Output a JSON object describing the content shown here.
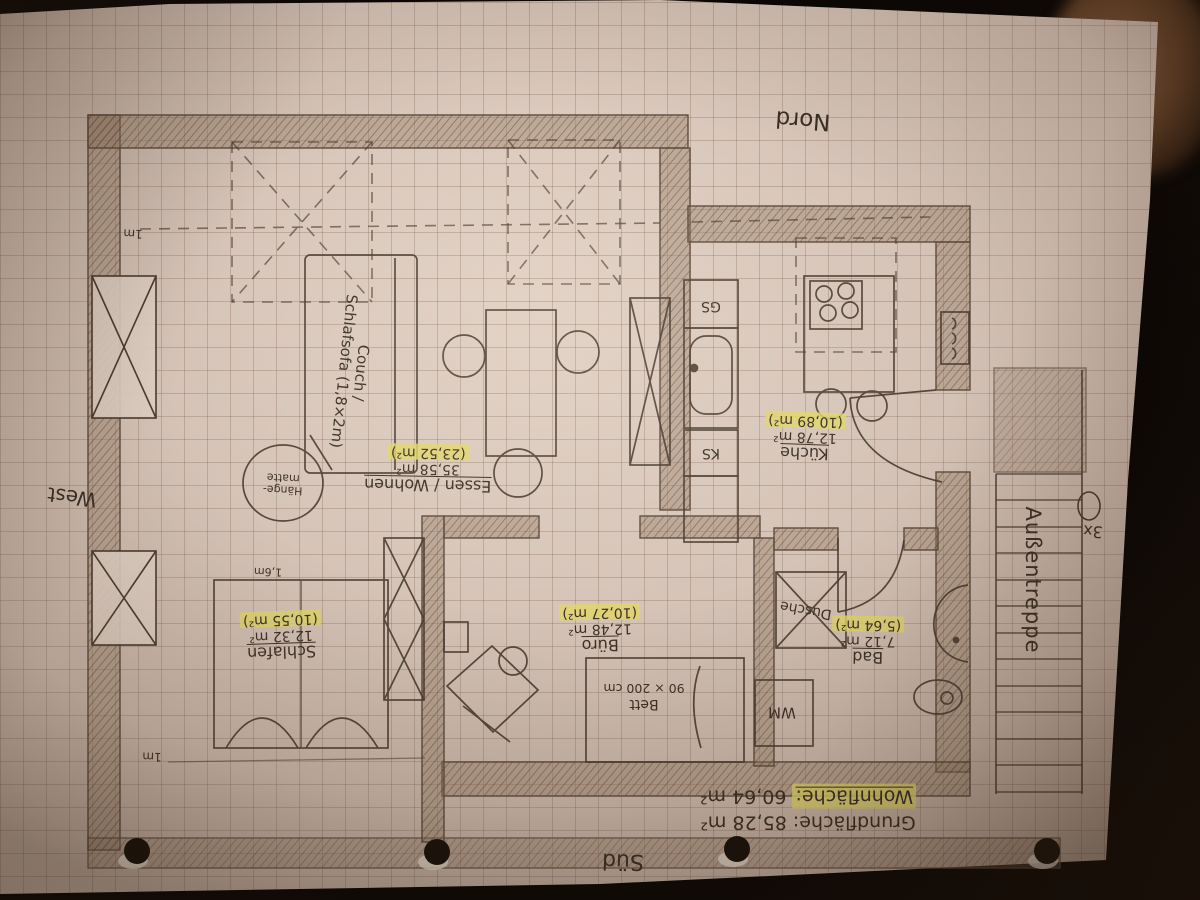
{
  "compass": {
    "north": "Nord",
    "south": "Süd",
    "west": "West"
  },
  "scale_marks": {
    "top": "1m",
    "bottom": "1m"
  },
  "rooms": {
    "living": {
      "name": "Essen / Wohnen",
      "area": "35,58 m²",
      "area_net": "(23,52 m²)"
    },
    "kitchen": {
      "name": "Küche",
      "area": "12,78 m²",
      "area_net": "(10,89 m²)"
    },
    "bath": {
      "name": "Bad",
      "area": "7,12 m²",
      "area_net": "(5,64 m²)"
    },
    "office": {
      "name": "Büro",
      "area": "12,48 m²",
      "area_net": "(10,27 m²)"
    },
    "bedroom": {
      "name": "Schlafen",
      "area": "12,32 m²",
      "area_net": "(10,55 m²)"
    }
  },
  "furniture": {
    "couch_line1": "Couch /",
    "couch_line2": "Schlafsofa (1,8×2m)",
    "hammock_line1": "Hänge-",
    "hammock_line2": "matte",
    "bed_label": "Bett",
    "bed_dimensions": "90 × 200 cm",
    "bed_width_note": "1,6m",
    "dishwasher_abbr": "GS",
    "fridge_abbr": "KS",
    "washing_machine_abbr": "WM",
    "shower_label": "Dusche"
  },
  "exterior": {
    "stairs_label": "Außentreppe",
    "stairs_count_note": "3x"
  },
  "summary": {
    "gross_label": "Grundfläche:",
    "gross_value": "85,28 m²",
    "net_label": "Wohnfläche:",
    "net_value": "60,64 m²"
  }
}
